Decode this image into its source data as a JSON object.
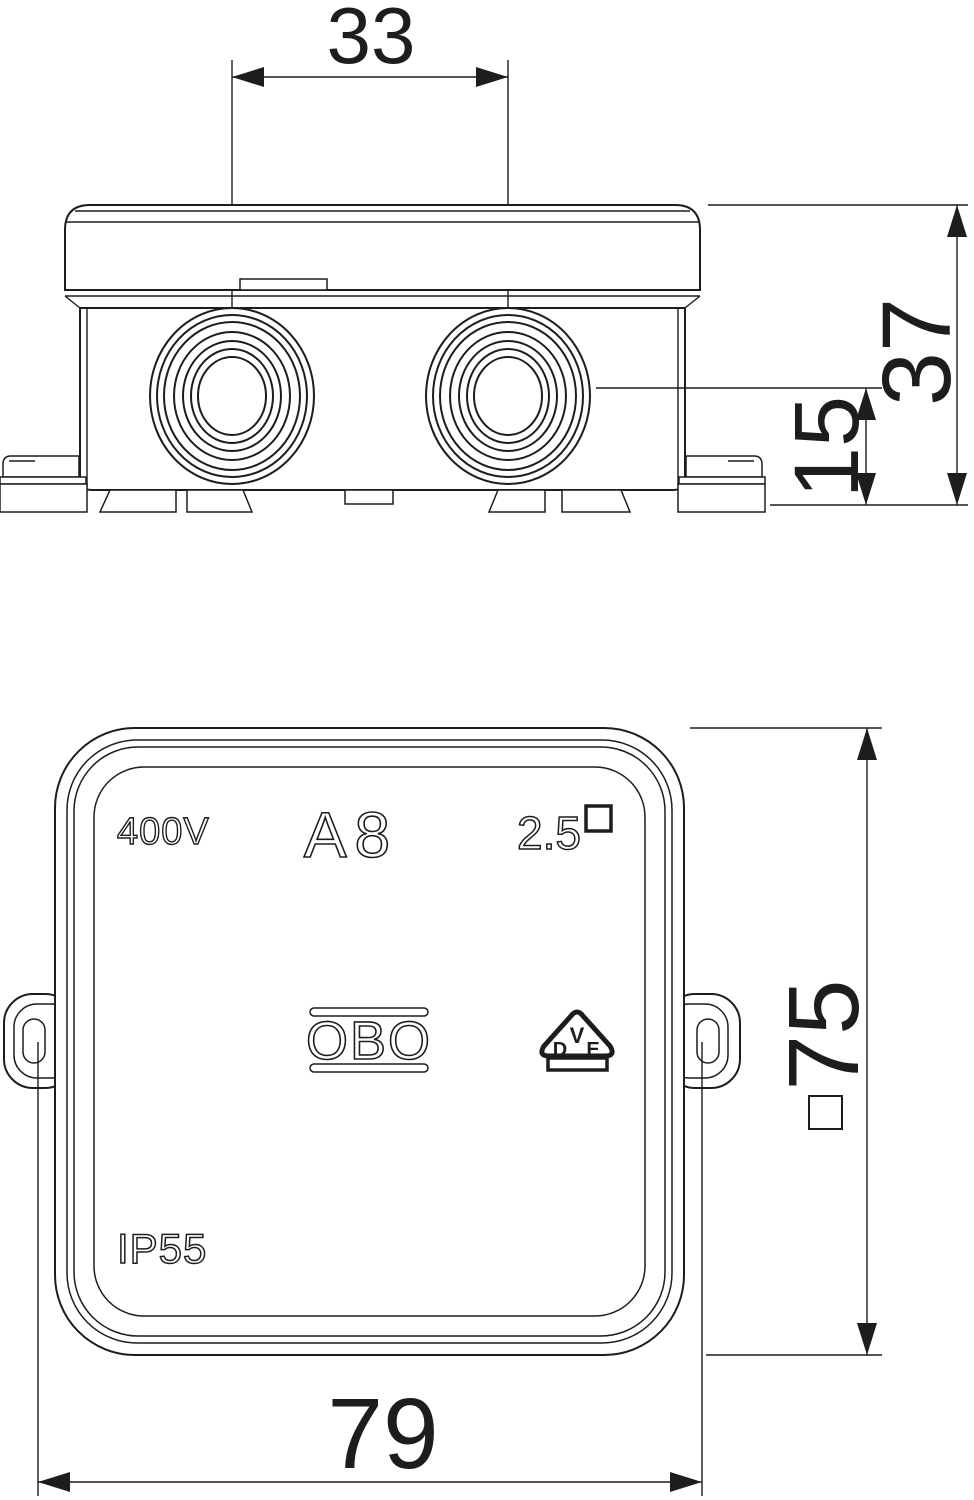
{
  "colors": {
    "line": "#1d1d1b",
    "background": "#ffffff"
  },
  "side_view": {
    "dim_entry_spacing": "33",
    "dim_total_height": "37",
    "dim_entry_height": "15"
  },
  "front_view": {
    "voltage_marking": "400V",
    "model_marking": "A8",
    "conductor_marking": "2.5",
    "conductor_symbol": "square",
    "brand_logo": "OBO",
    "vde": {
      "v": "V",
      "d": "D",
      "e": "E"
    },
    "ip_rating": "IP55",
    "dim_square_symbol": "square",
    "dim_square_size": "75",
    "dim_overall_width": "79"
  }
}
